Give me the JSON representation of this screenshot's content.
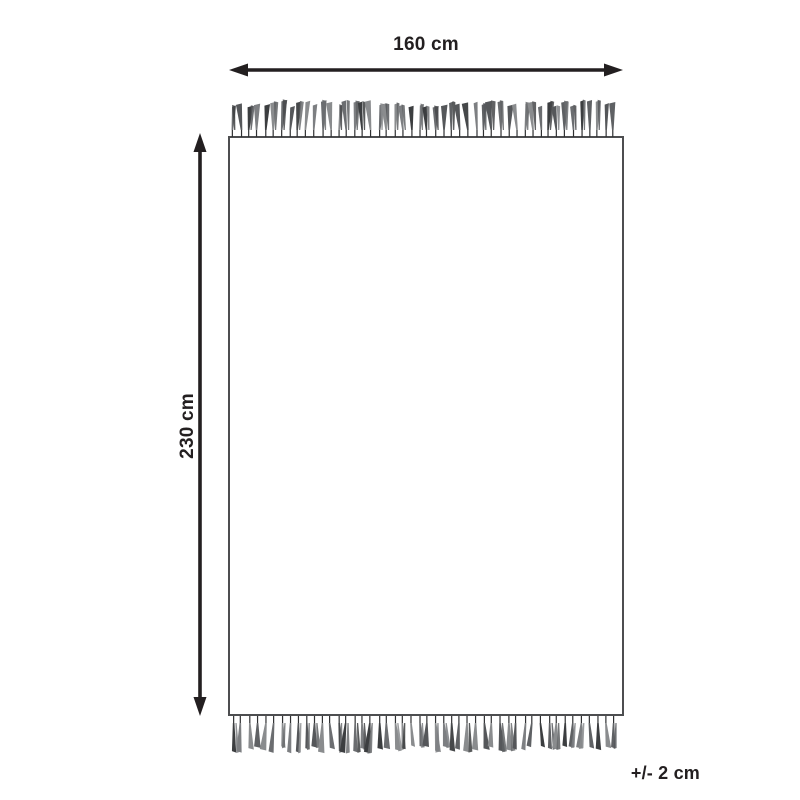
{
  "diagram": {
    "width_label": "160 cm",
    "height_label": "230 cm",
    "tolerance_label": "+/- 2 cm"
  },
  "colors": {
    "line": "#231f20",
    "rug_border": "#4d4e50",
    "rug_fill": "#ffffff",
    "stem": "#2f3032",
    "fringe_palette": [
      "#46484a",
      "#6b6d70",
      "#55575a",
      "#7d7f82",
      "#3c3e40",
      "#8a8c8e",
      "#5f6164"
    ]
  }
}
